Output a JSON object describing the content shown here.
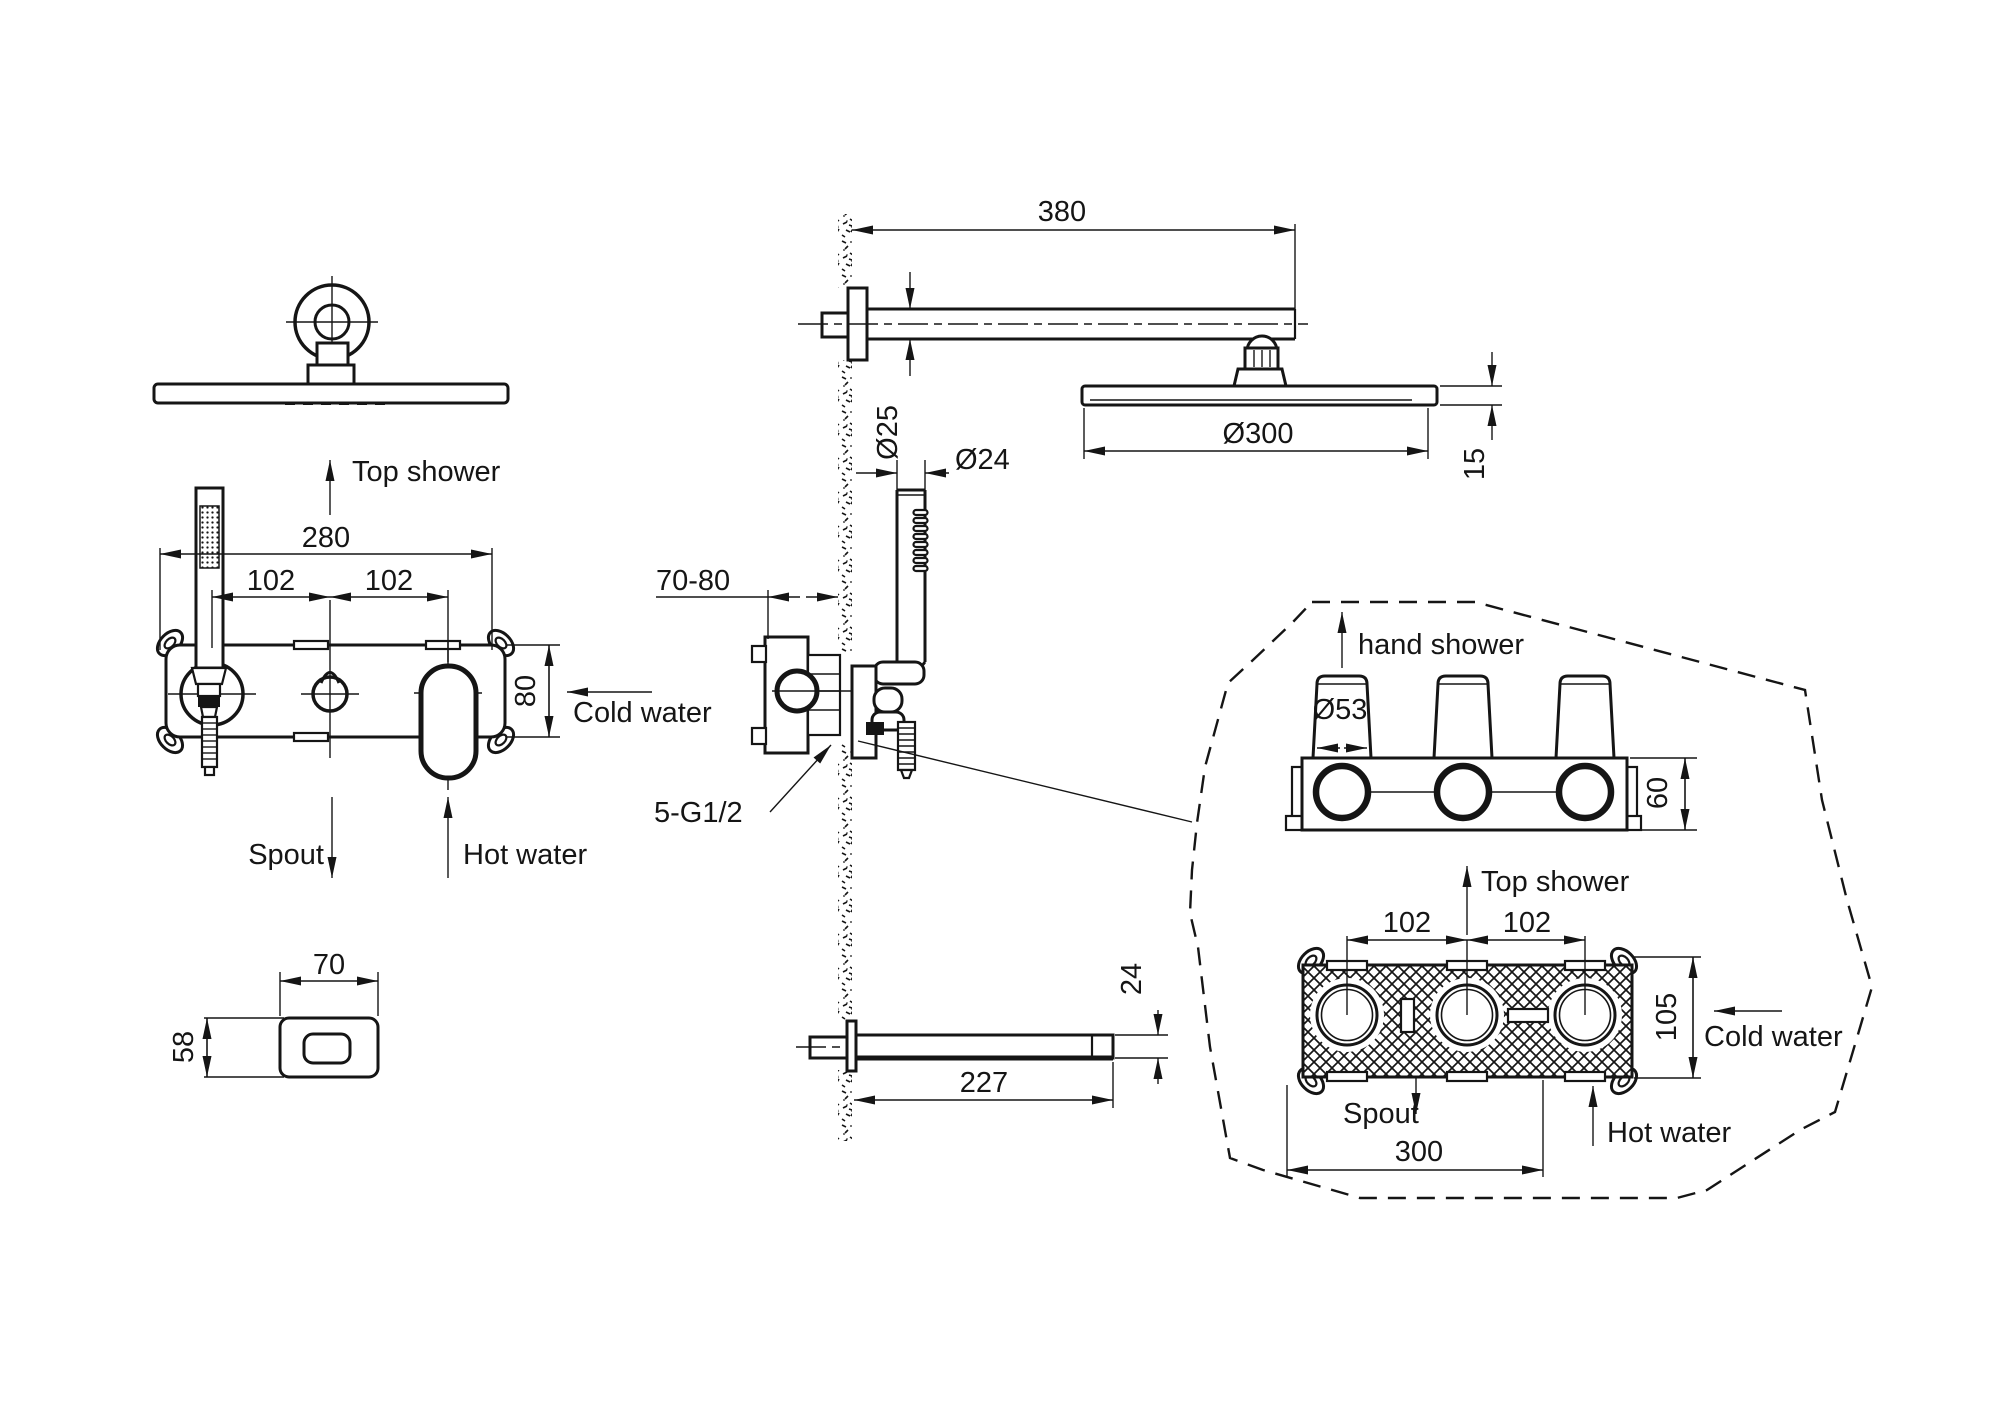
{
  "drawing": {
    "background": "#ffffff",
    "line_color": "#151515",
    "front_view": {
      "top_shower_label": "Top shower",
      "dim_width": "280",
      "dim_spacing_left": "102",
      "dim_spacing_right": "102",
      "dim_height": "80",
      "cold_water_label": "Cold water",
      "spout_label": "Spout",
      "hot_water_label": "Hot water"
    },
    "spout_front_view": {
      "dim_width": "70",
      "dim_height": "58"
    },
    "side_view": {
      "dim_arm_length": "380",
      "dim_arm_diameter": "Ø25",
      "dim_hand_shower_diameter": "Ø24",
      "dim_head_diameter": "Ø300",
      "dim_head_thickness": "15",
      "dim_embed_depth": "70-80",
      "thread_spec": "5-G1/2",
      "dim_spout_height": "24",
      "dim_spout_length": "227"
    },
    "detail_view": {
      "hand_shower_label": "hand shower",
      "dim_port_diameter": "Ø53",
      "dim_body_depth": "60",
      "top_shower_label": "Top shower",
      "dim_spacing_left": "102",
      "dim_spacing_right": "102",
      "dim_body_height": "105",
      "cold_water_label": "Cold water",
      "spout_label": "Spout",
      "hot_water_label": "Hot water",
      "dim_body_width": "300"
    }
  }
}
